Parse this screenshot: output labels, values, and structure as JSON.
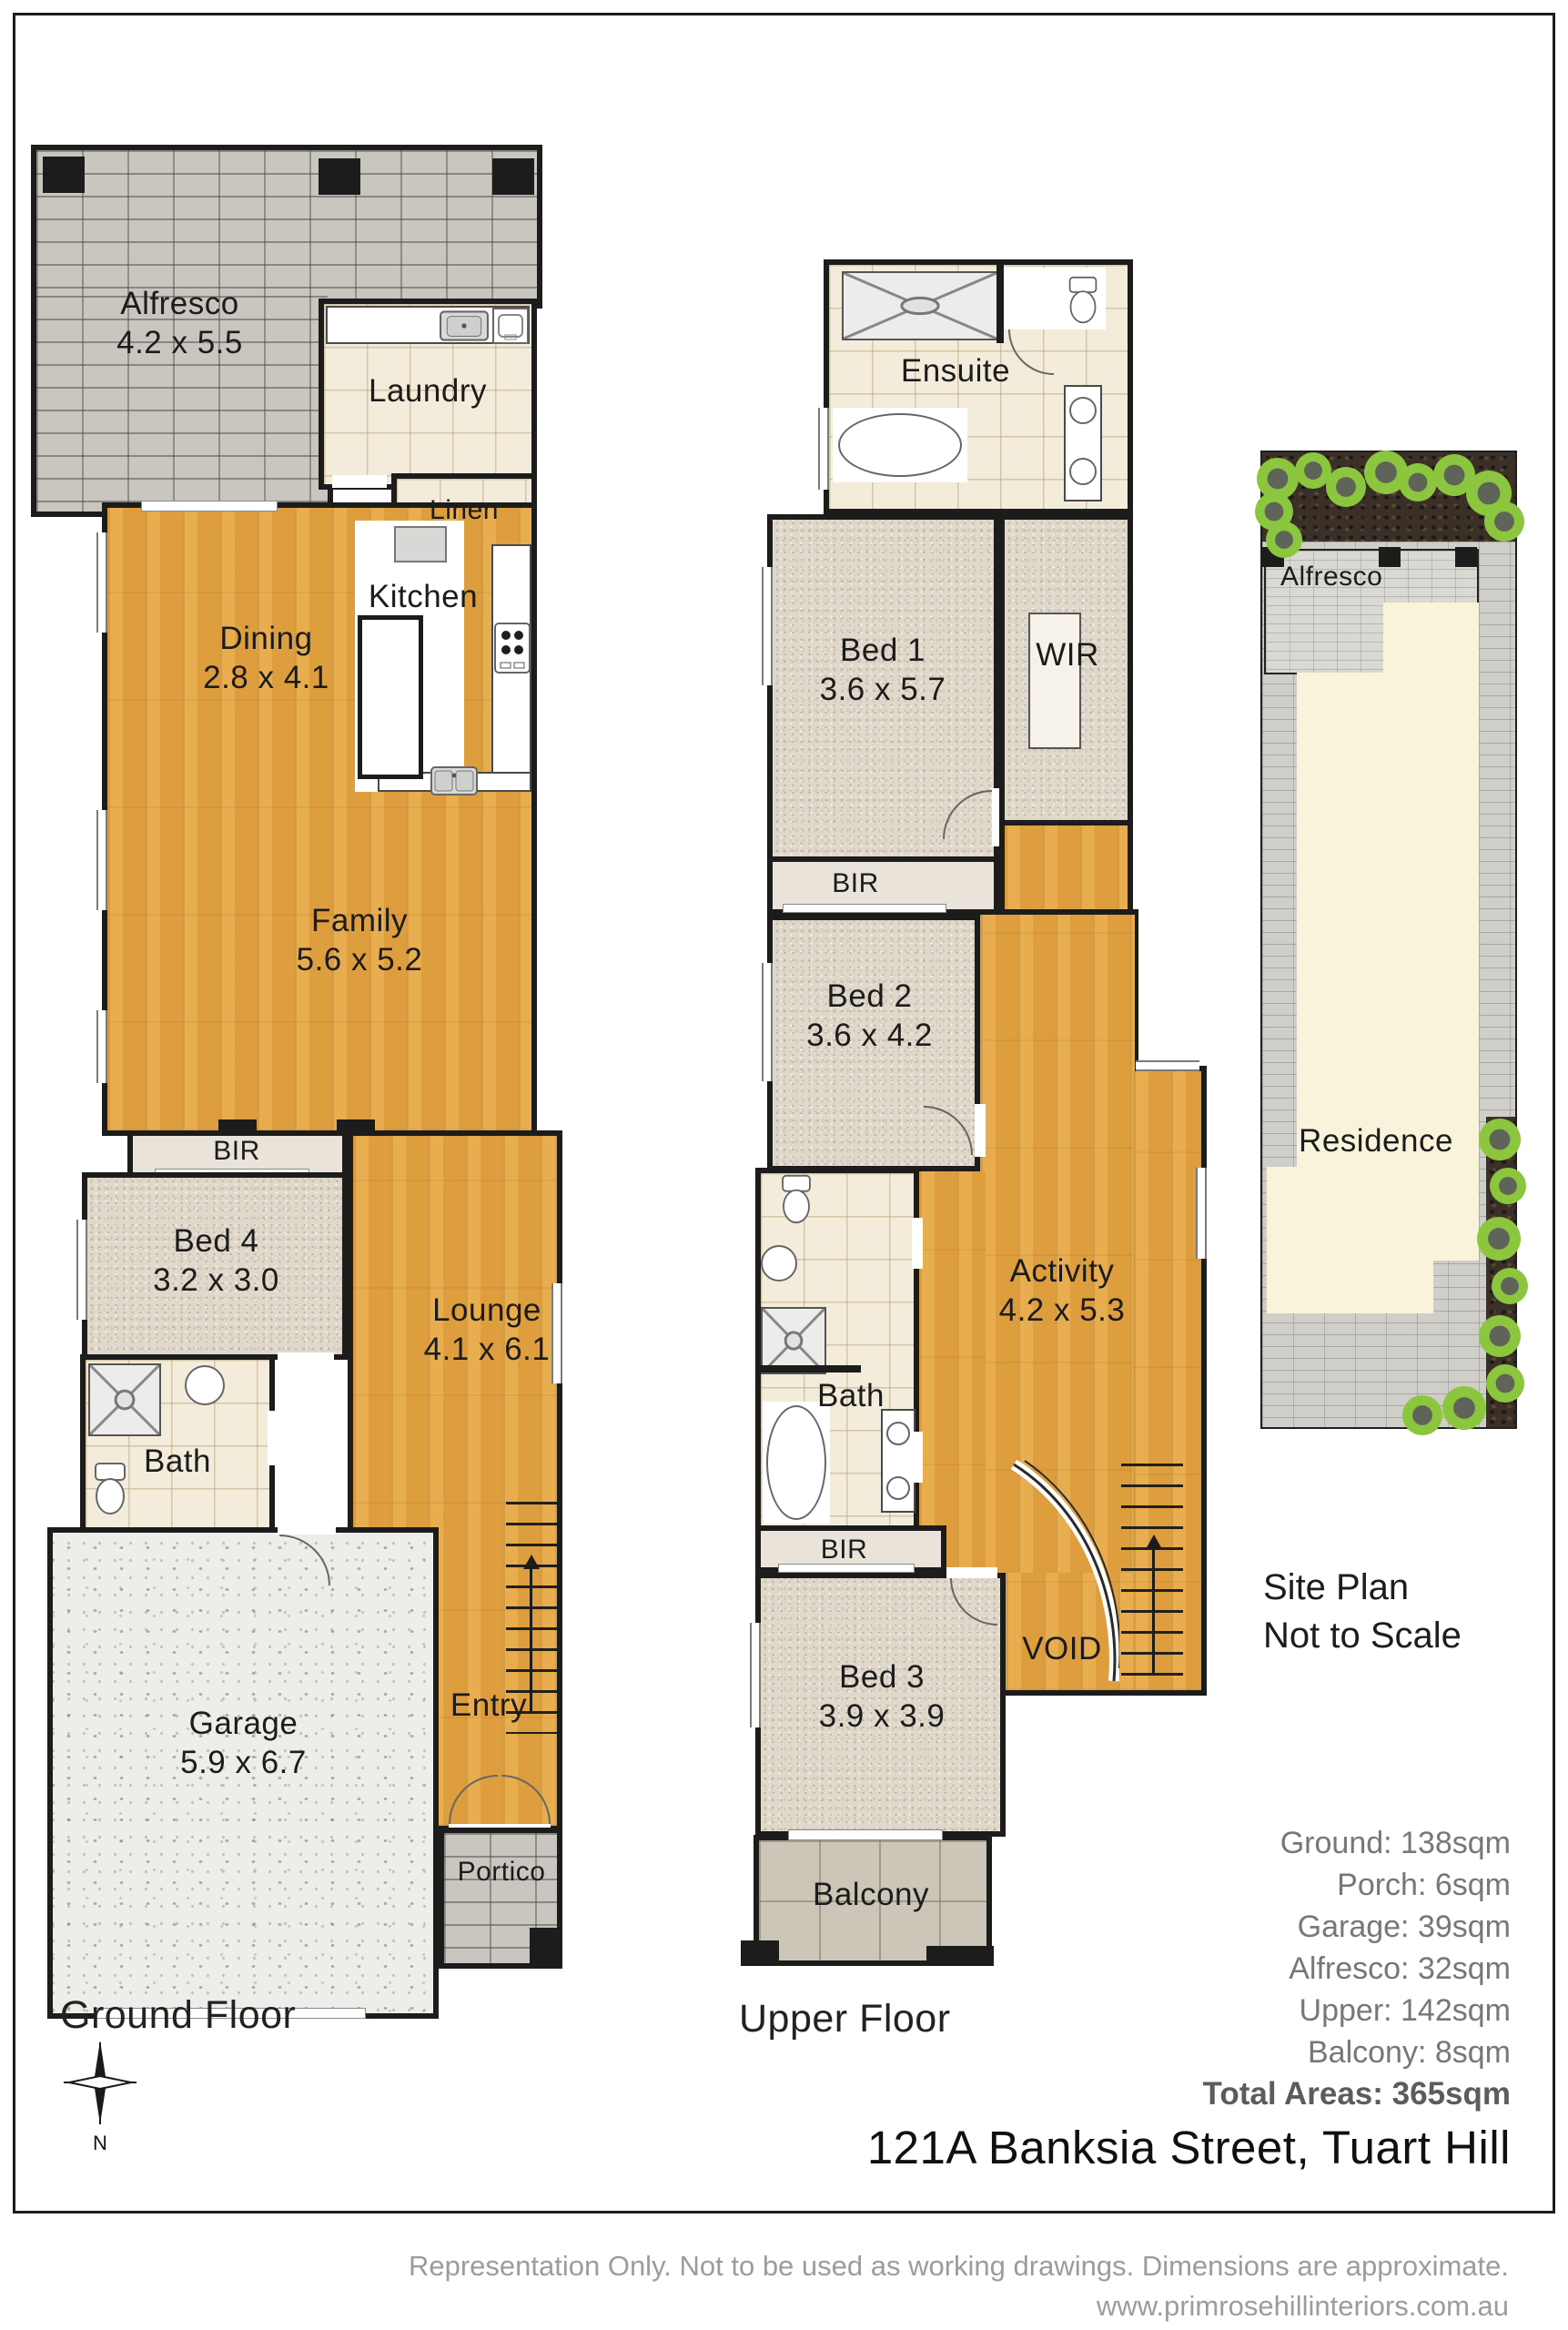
{
  "ground_floor": {
    "title": "Ground Floor",
    "alfresco": {
      "name": "Alfresco",
      "dims": "4.2 x 5.5"
    },
    "laundry": {
      "name": "Laundry"
    },
    "linen": {
      "name": "Linen"
    },
    "kitchen": {
      "name": "Kitchen"
    },
    "dining": {
      "name": "Dining",
      "dims": "2.8 x 4.1"
    },
    "family": {
      "name": "Family",
      "dims": "5.6 x 5.2"
    },
    "bir": {
      "name": "BIR"
    },
    "bed4": {
      "name": "Bed 4",
      "dims": "3.2 x 3.0"
    },
    "lounge": {
      "name": "Lounge",
      "dims": "4.1 x 6.1"
    },
    "bath": {
      "name": "Bath"
    },
    "garage": {
      "name": "Garage",
      "dims": "5.9 x 6.7"
    },
    "entry": {
      "name": "Entry"
    },
    "portico": {
      "name": "Portico"
    }
  },
  "upper_floor": {
    "title": "Upper Floor",
    "ensuite": {
      "name": "Ensuite"
    },
    "bed1": {
      "name": "Bed 1",
      "dims": "3.6 x 5.7"
    },
    "wir": {
      "name": "WIR"
    },
    "bir1": {
      "name": "BIR"
    },
    "bed2": {
      "name": "Bed 2",
      "dims": "3.6 x 4.2"
    },
    "bath": {
      "name": "Bath"
    },
    "activity": {
      "name": "Activity",
      "dims": "4.2 x 5.3"
    },
    "bir2": {
      "name": "BIR"
    },
    "bed3": {
      "name": "Bed 3",
      "dims": "3.9 x 3.9"
    },
    "void": {
      "name": "VOID"
    },
    "balcony": {
      "name": "Balcony"
    }
  },
  "site_plan": {
    "alfresco_label": "Alfresco",
    "residence_label": "Residence",
    "caption_line1": "Site Plan",
    "caption_line2": "Not to Scale"
  },
  "areas": {
    "items": [
      "Ground: 138sqm",
      "Porch: 6sqm",
      "Garage: 39sqm",
      "Alfresco: 32sqm",
      "Upper: 142sqm",
      "Balcony: 8sqm"
    ],
    "total": "Total Areas: 365sqm"
  },
  "address": "121A Banksia Street, Tuart Hill",
  "compass": {
    "label": "N"
  },
  "footer": {
    "line1": "Representation Only. Not to be used as working drawings. Dimensions are approximate.",
    "line2": "www.primrosehillinteriors.com.au"
  },
  "colors": {
    "wall": "#1c1c1c",
    "wood_floor": "#e2a443",
    "carpet": "#dfd8cb",
    "tile": "#f3ecdb",
    "brick_paving": "#c9c6c0",
    "concrete": "#edede9",
    "site_paving": "#cfcec9",
    "site_garden": "#3a3028",
    "site_bush": "#8cc63e",
    "residence_fill": "#faf3dc",
    "area_text": "#76777a",
    "footer_text": "#9c9c9c"
  }
}
